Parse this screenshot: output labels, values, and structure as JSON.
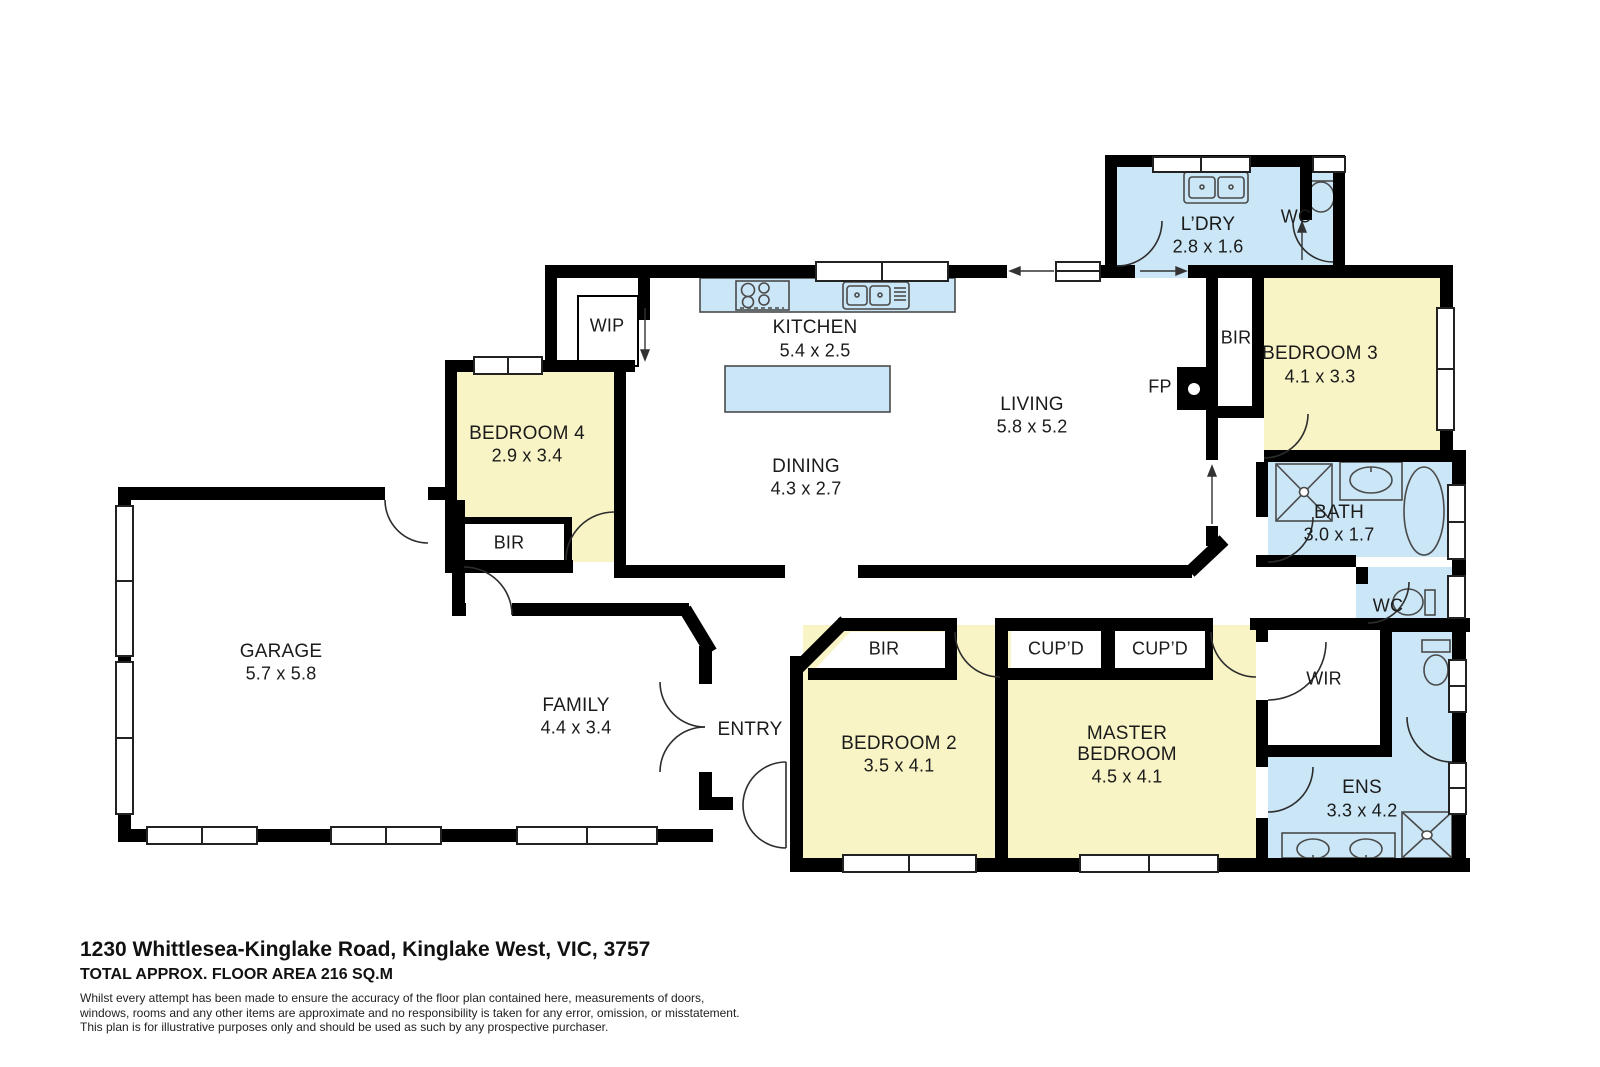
{
  "colors": {
    "room_yellow": "#F8F4C5",
    "wet_blue": "#CBE7F7",
    "wall_black": "#000000",
    "fixture_stroke": "#4a4a4a",
    "label_color": "#1b1b1b"
  },
  "rooms": {
    "laundry": {
      "name": "L’DRY",
      "dims": "2.8 x 1.6"
    },
    "wc_top": {
      "name": "WC"
    },
    "bedroom3": {
      "name": "BEDROOM 3",
      "dims": "4.1 x 3.3"
    },
    "kitchen": {
      "name": "KITCHEN",
      "dims": "5.4 x 2.5"
    },
    "living": {
      "name": "LIVING",
      "dims": "5.8 x 5.2"
    },
    "dining": {
      "name": "DINING",
      "dims": "4.3 x 2.7"
    },
    "bedroom4": {
      "name": "BEDROOM 4",
      "dims": "2.9 x 3.4"
    },
    "garage": {
      "name": "GARAGE",
      "dims": "5.7 x 5.8"
    },
    "family": {
      "name": "FAMILY",
      "dims": "4.4 x 3.4"
    },
    "entry": {
      "name": "ENTRY"
    },
    "bedroom2": {
      "name": "BEDROOM 2",
      "dims": "3.5 x 4.1"
    },
    "master": {
      "name": "MASTER BEDROOM",
      "dims": "4.5 x 4.1"
    },
    "wir": {
      "name": "WIR"
    },
    "bath": {
      "name": "BATH",
      "dims": "3.0 x 1.7"
    },
    "wc_mid": {
      "name": "WC"
    },
    "ens": {
      "name": "ENS",
      "dims": "3.3 x 4.2"
    }
  },
  "closets": {
    "bir": "BIR",
    "wip": "WIP",
    "cupd": "CUP’D",
    "fp": "FP"
  },
  "footer": {
    "address": "1230 Whittlesea-Kinglake Road, Kinglake West, VIC, 3757",
    "area": "TOTAL APPROX. FLOOR AREA 216 SQ.M",
    "disclaimer": [
      "Whilst every attempt has been made to ensure the accuracy of the floor plan contained here, measurements of doors,",
      "windows, rooms and any other items are approximate and no responsibility is taken for any error, omission, or misstatement.",
      "This plan is for illustrative purposes only and should be used as such by any prospective purchaser."
    ]
  }
}
